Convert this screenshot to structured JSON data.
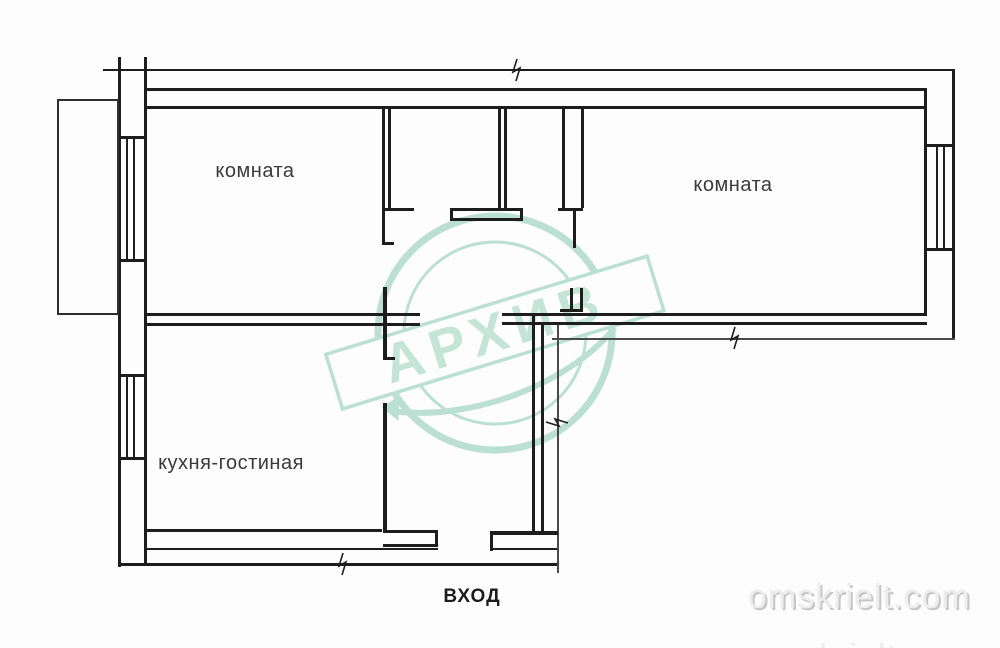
{
  "plan": {
    "rooms": [
      {
        "id": "room-1",
        "label": "комната"
      },
      {
        "id": "room-2",
        "label": "комната"
      },
      {
        "id": "kitchen-living",
        "label": "кухня-гостиная"
      }
    ],
    "entrance_label": "ВХОД"
  },
  "stamp": {
    "text": "АРХИВ",
    "color": "#b4ddcf",
    "text_color": "#bfe2d5"
  },
  "site_watermark": {
    "text": "omskrielt.com",
    "partial_text": "omskrielt.com"
  },
  "canvas": {
    "background": "#fdfdfd",
    "line_color": "#1d1d1d"
  }
}
